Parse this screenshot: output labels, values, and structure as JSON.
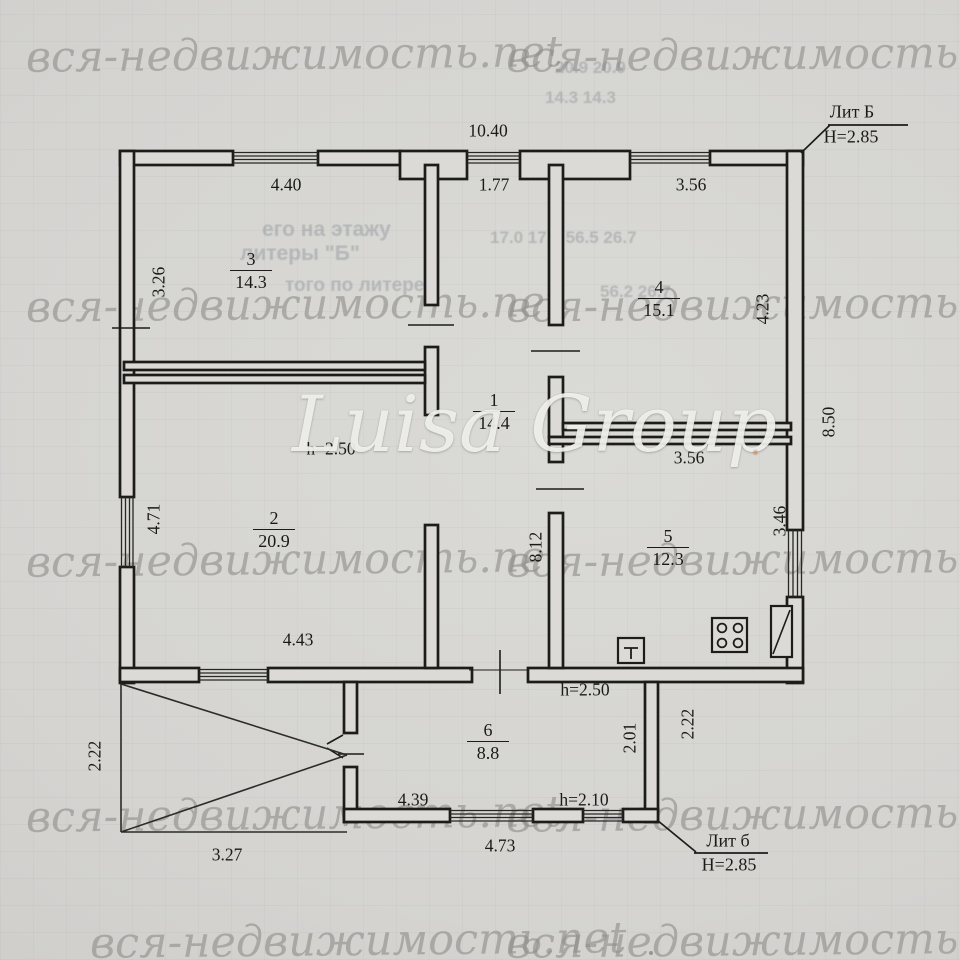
{
  "watermark": {
    "text": "вся-недвижимость.net",
    "agency": "Luisa Group",
    "rows": [
      {
        "x": 26,
        "y": 30
      },
      {
        "x": 506,
        "y": 30
      },
      {
        "x": 26,
        "y": 280
      },
      {
        "x": 506,
        "y": 280
      },
      {
        "x": 26,
        "y": 535
      },
      {
        "x": 506,
        "y": 535
      },
      {
        "x": 26,
        "y": 790
      },
      {
        "x": 506,
        "y": 790
      },
      {
        "x": 90,
        "y": 916
      },
      {
        "x": 506,
        "y": 916
      }
    ]
  },
  "plan": {
    "rooms": [
      {
        "id": "room-3",
        "number": "3",
        "area": "14.3",
        "x": 251,
        "y": 250
      },
      {
        "id": "room-4",
        "number": "4",
        "area": "15.1",
        "x": 659,
        "y": 278
      },
      {
        "id": "room-1",
        "number": "1",
        "area": "14.4",
        "x": 494,
        "y": 391
      },
      {
        "id": "room-2",
        "number": "2",
        "area": "20.9",
        "x": 274,
        "y": 509
      },
      {
        "id": "room-5",
        "number": "5",
        "area": "12.3",
        "x": 668,
        "y": 527
      },
      {
        "id": "room-6",
        "number": "6",
        "area": "8.8",
        "x": 488,
        "y": 721
      }
    ],
    "dimensions": [
      {
        "id": "dim-total-width",
        "text": "10.40",
        "x": 488,
        "y": 131
      },
      {
        "id": "dim-room3-width",
        "text": "4.40",
        "x": 286,
        "y": 185
      },
      {
        "id": "dim-hall-width",
        "text": "1.77",
        "x": 494,
        "y": 185
      },
      {
        "id": "dim-room4-width",
        "text": "3.56",
        "x": 691,
        "y": 185
      },
      {
        "id": "dim-room3-depth",
        "text": "3.26",
        "x": 159,
        "y": 282,
        "v": 1
      },
      {
        "id": "dim-room4-depth",
        "text": "4.23",
        "x": 763,
        "y": 309,
        "v": 1
      },
      {
        "id": "dim-right-side",
        "text": "8.50",
        "x": 829,
        "y": 422,
        "v": 1
      },
      {
        "id": "dim-h-room2",
        "text": "h=2.50",
        "x": 331,
        "y": 449
      },
      {
        "id": "dim-room5-width",
        "text": "3.56",
        "x": 689,
        "y": 458
      },
      {
        "id": "dim-room2-depth",
        "text": "4.71",
        "x": 154,
        "y": 519,
        "v": 1
      },
      {
        "id": "dim-hall-length",
        "text": "8.12",
        "x": 536,
        "y": 547,
        "v": 1
      },
      {
        "id": "dim-room5-depth",
        "text": "3.46",
        "x": 780,
        "y": 521,
        "v": 1
      },
      {
        "id": "dim-room2-width",
        "text": "4.43",
        "x": 298,
        "y": 640
      },
      {
        "id": "dim-h-room6-top",
        "text": "h=2.50",
        "x": 585,
        "y": 690
      },
      {
        "id": "dim-porch-depth",
        "text": "2.22",
        "x": 95,
        "y": 756,
        "v": 1
      },
      {
        "id": "dim-room6-depth",
        "text": "2.01",
        "x": 630,
        "y": 738,
        "v": 1
      },
      {
        "id": "dim-room6-side",
        "text": "2.22",
        "x": 688,
        "y": 724,
        "v": 1
      },
      {
        "id": "dim-room6-width",
        "text": "4.39",
        "x": 413,
        "y": 800
      },
      {
        "id": "dim-h-room6",
        "text": "h=2.10",
        "x": 584,
        "y": 800
      },
      {
        "id": "dim-room6-bottom",
        "text": "4.73",
        "x": 500,
        "y": 846
      },
      {
        "id": "dim-porch-width",
        "text": "3.27",
        "x": 227,
        "y": 855
      }
    ],
    "annotations": [
      {
        "id": "lit-B",
        "title": "Лит Б",
        "height": "Н=2.85",
        "tx": 852,
        "ty": 112,
        "hx": 851,
        "hy": 137
      },
      {
        "id": "lit-b",
        "title": "Лит б",
        "height": "Н=2.85",
        "tx": 728,
        "ty": 841,
        "hx": 729,
        "hy": 865
      }
    ],
    "ghost_text": [
      {
        "text": "его на этажу",
        "x": 262,
        "y": 218,
        "size": 21
      },
      {
        "text": "литеры \"Б\"",
        "x": 240,
        "y": 242,
        "size": 21
      },
      {
        "text": "того по литере",
        "x": 285,
        "y": 275,
        "size": 19
      },
      {
        "text": "17.0  17.0  56.5  26.7",
        "x": 490,
        "y": 228,
        "size": 17
      },
      {
        "text": "56.2  26.7",
        "x": 600,
        "y": 282,
        "size": 17
      },
      {
        "text": "20.9   20.9",
        "x": 555,
        "y": 58,
        "size": 17
      },
      {
        "text": "14.3   14.3",
        "x": 545,
        "y": 88,
        "size": 17
      }
    ],
    "colors": {
      "wall_line": "#1c1c1b",
      "paper": "#d5d4d1",
      "watermark_gray": "#8f8e8a",
      "text": "#1a1a19"
    }
  }
}
